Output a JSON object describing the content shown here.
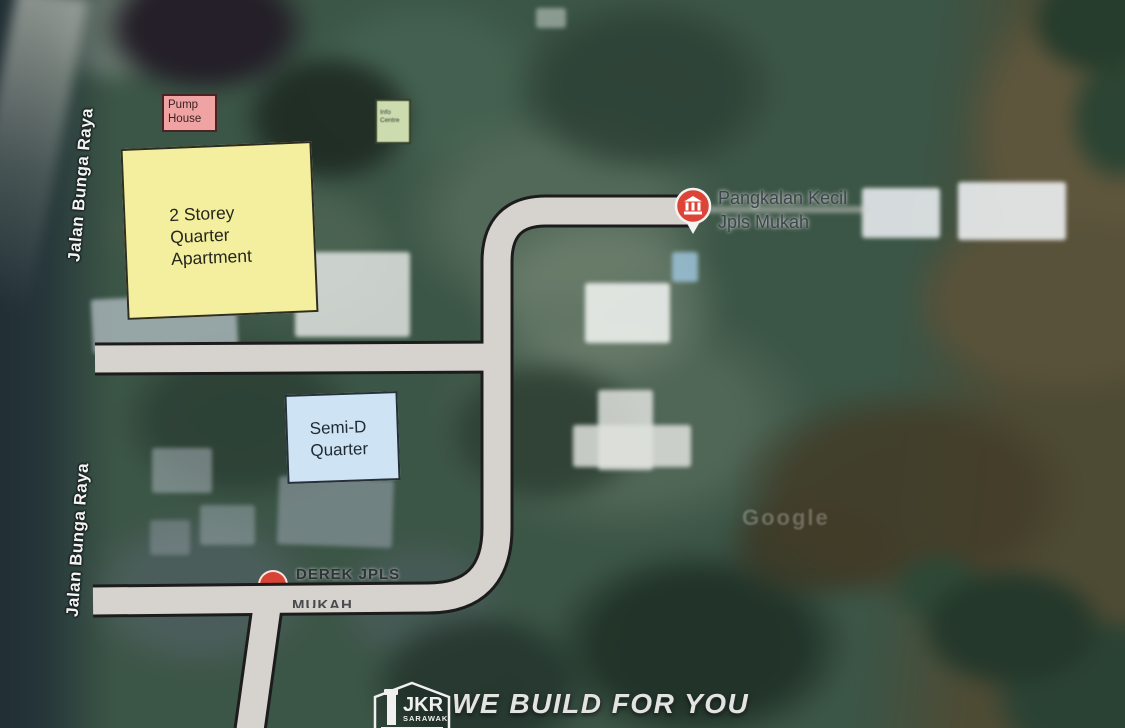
{
  "colors": {
    "marker_red": "#dc4437",
    "road_fill": "#d6d3cf",
    "apartment_fill": "#f3ef9f",
    "semid_fill": "#cee3f3",
    "pump_house_fill": "#efa3a3",
    "centre_fill": "#ccdcae"
  },
  "road_labels": {
    "upper": "Jalan Bunga Raya",
    "lower": "Jalan Bunga Raya"
  },
  "annotations": {
    "pump_house": {
      "line1": "Pump",
      "line2": "House"
    },
    "centre": {
      "line1": "Info",
      "line2": "Centre"
    },
    "apartment": {
      "line1": "2 Storey",
      "line2": "Quarter",
      "line3": "Apartment"
    },
    "semid": {
      "line1": "Semi-D",
      "line2": "Quarter"
    }
  },
  "markers": {
    "pangkalan": {
      "line1": "Pangkalan Kecil",
      "line2": "Jpls Mukah"
    },
    "derek": {
      "line1": "DEREK JPLS",
      "line2": "MUKAH"
    }
  },
  "watermark": "Google",
  "footer": {
    "logo": "JKR",
    "logo_sub": "SARAWAK",
    "slogan": "WE BUILD FOR YOU"
  }
}
